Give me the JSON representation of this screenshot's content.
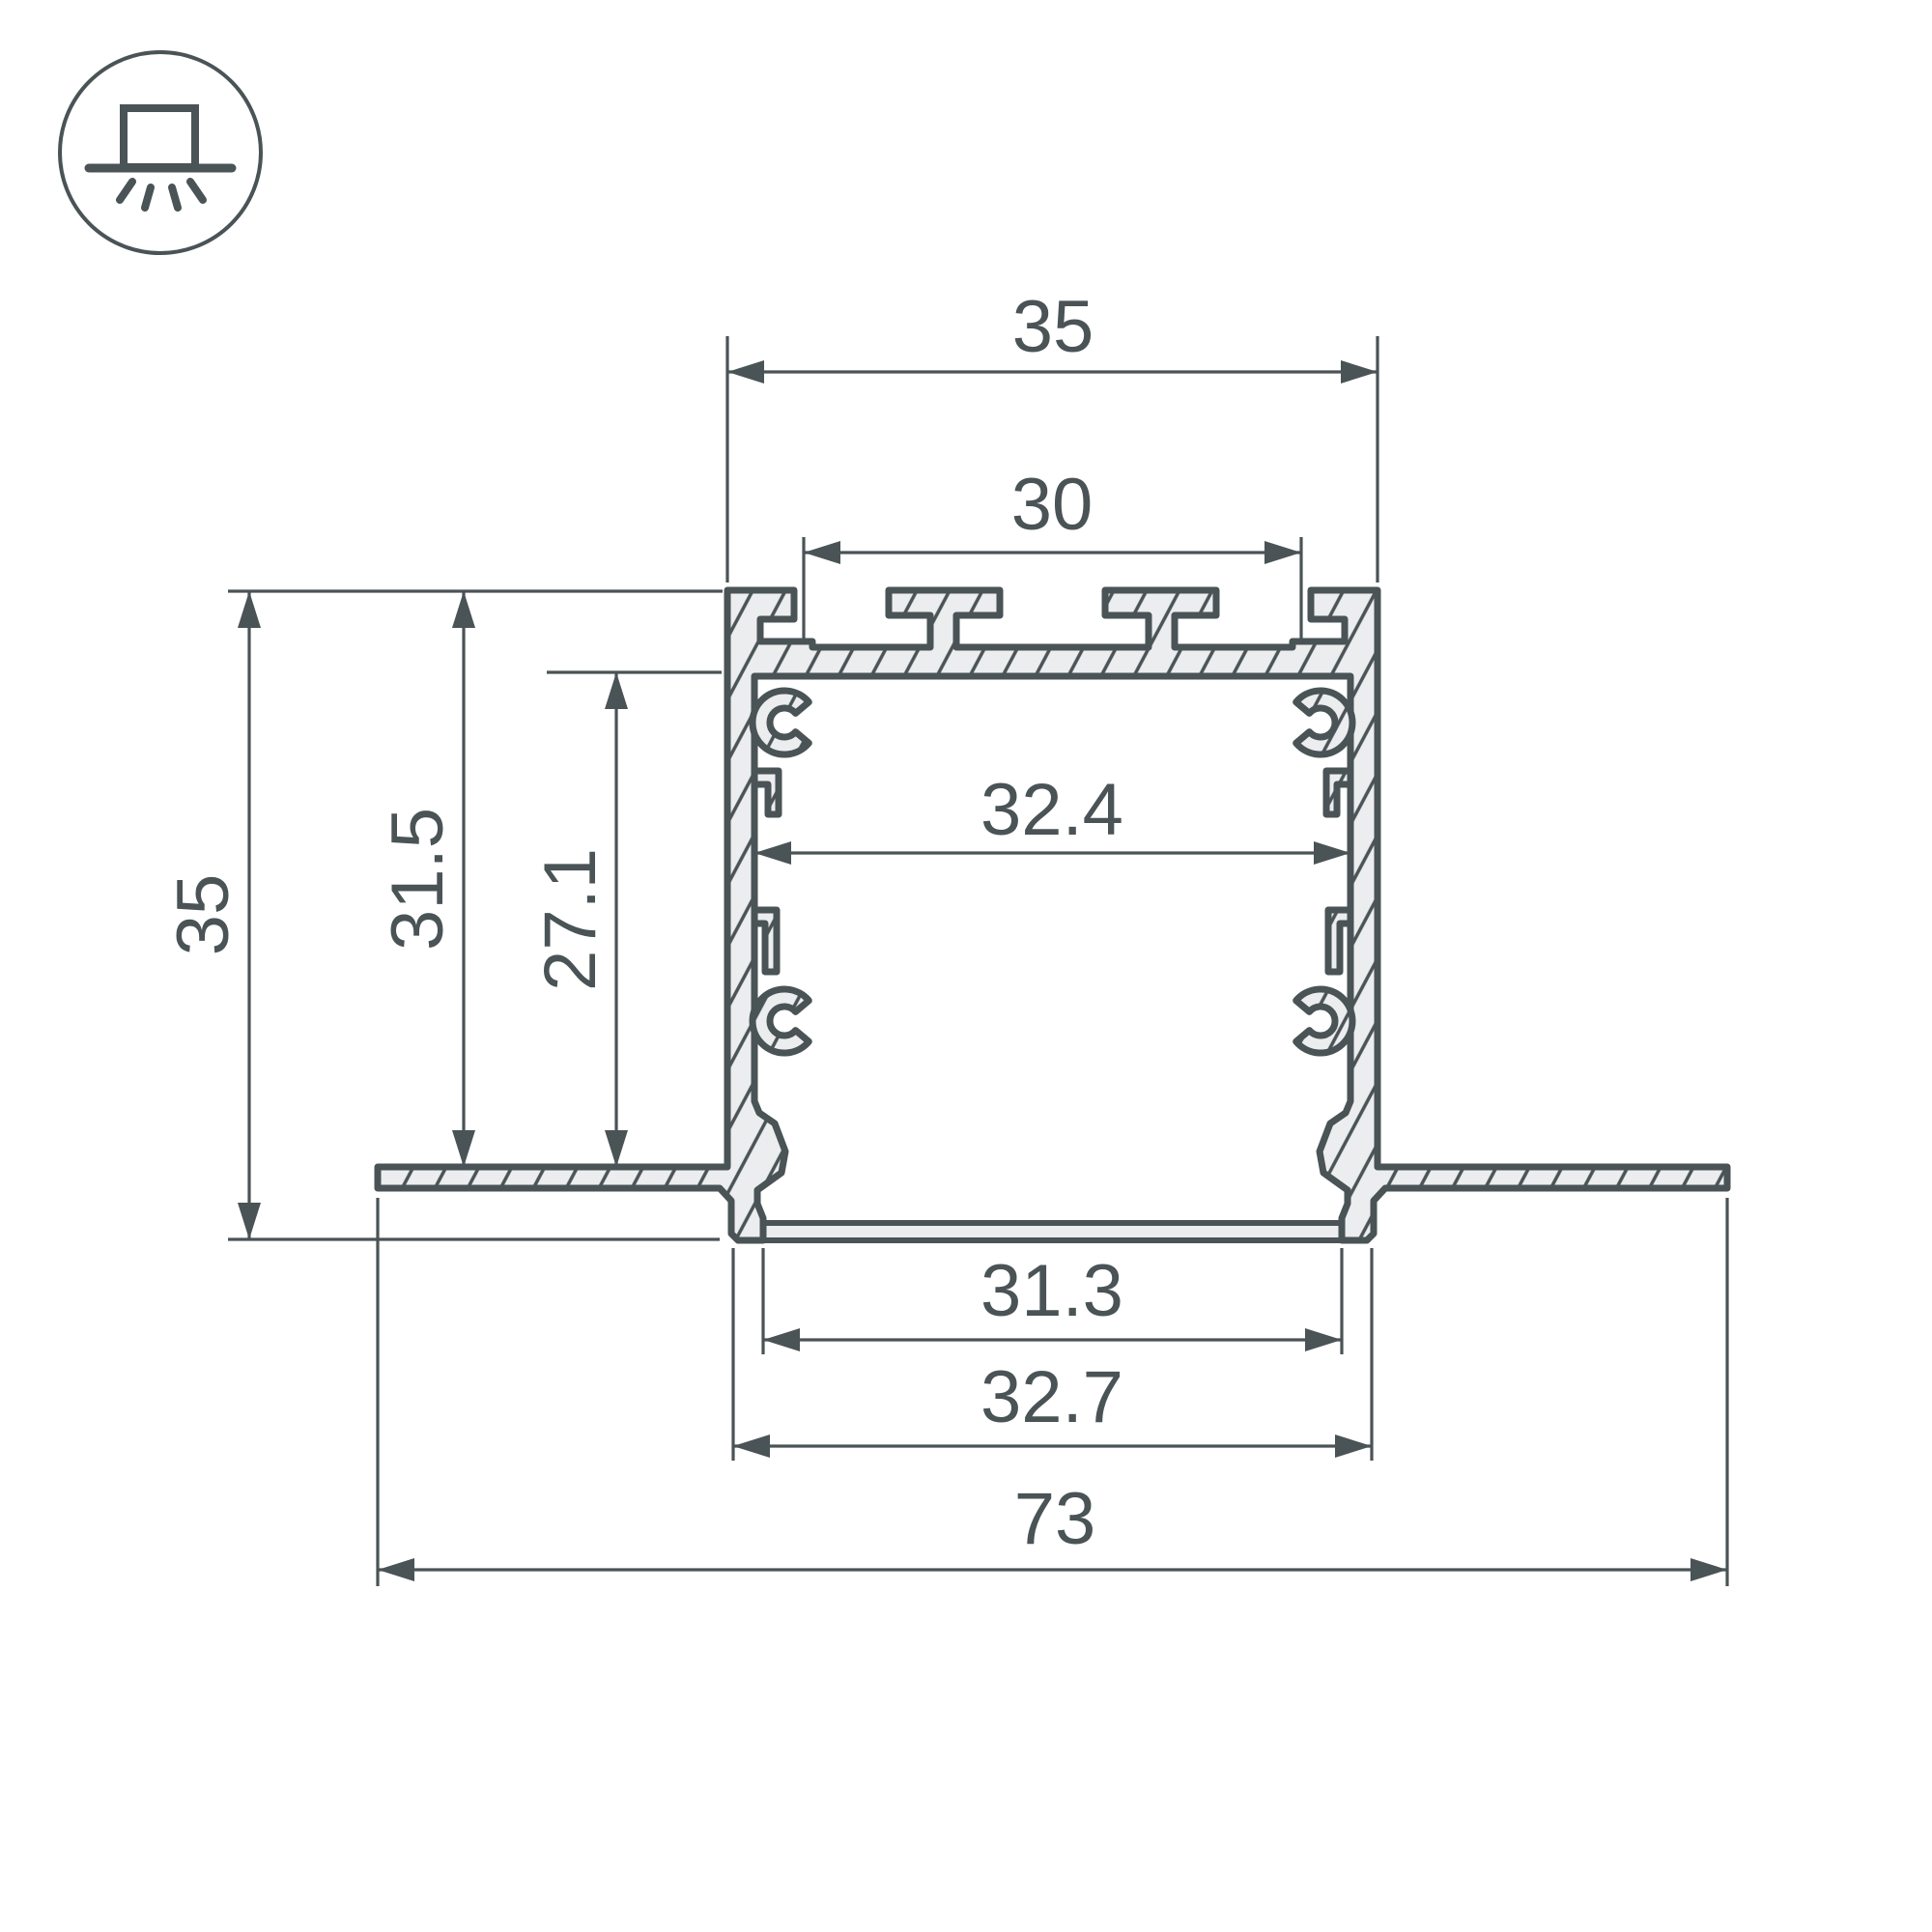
{
  "drawing": {
    "type": "profile-cross-section",
    "stroke_color": "#4A5356",
    "fill_color": "#ECEDEE",
    "icon": "recessed-mount-icon",
    "dimensions": {
      "top_width": "35",
      "top_inner_width": "30",
      "inner_width": "32.4",
      "height_total": "35",
      "height_wall": "31.5",
      "height_inner": "27.1",
      "bottom_opening": "31.3",
      "bottom_width": "32.7",
      "overall_width": "73"
    }
  }
}
